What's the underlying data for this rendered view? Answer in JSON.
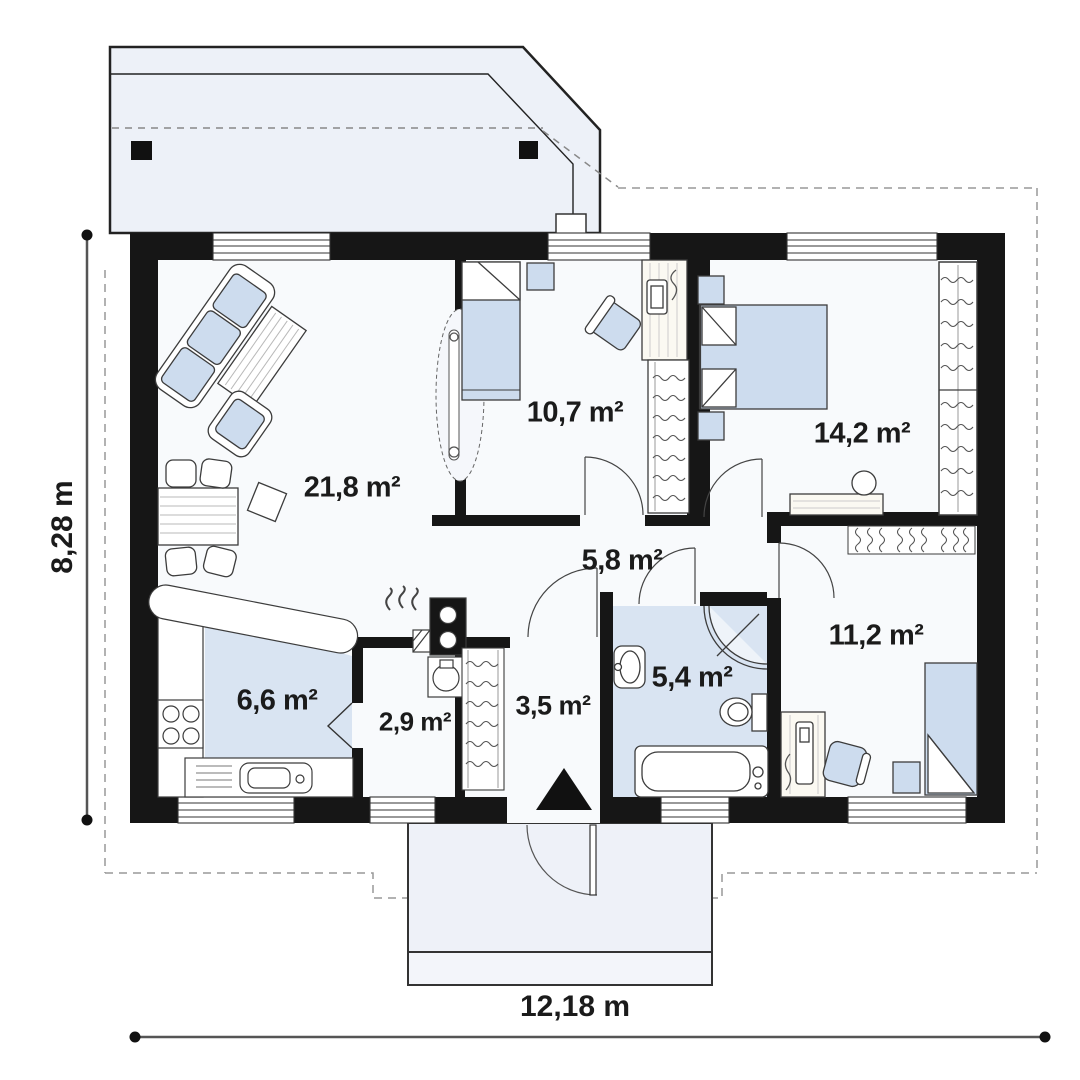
{
  "floor_plan": {
    "rooms": [
      {
        "id": "living-room",
        "area": "21,8 m²"
      },
      {
        "id": "bedroom-top",
        "area": "10,7 m²"
      },
      {
        "id": "bedroom-right",
        "area": "14,2 m²"
      },
      {
        "id": "hall",
        "area": "5,8 m²"
      },
      {
        "id": "bedroom-bottom-right",
        "area": "11,2 m²"
      },
      {
        "id": "kitchen",
        "area": "6,6 m²"
      },
      {
        "id": "pantry",
        "area": "2,9 m²"
      },
      {
        "id": "entry-hall",
        "area": "3,5 m²"
      },
      {
        "id": "bathroom",
        "area": "5,4 m²"
      }
    ],
    "dimensions": {
      "width": "12,18 m",
      "height": "8,28 m"
    },
    "colors": {
      "wall": "#161616",
      "furniture_fill": "#cddcee",
      "floor_highlight": "#d9e4f2",
      "terrace_fill": "#edf1f8"
    }
  }
}
